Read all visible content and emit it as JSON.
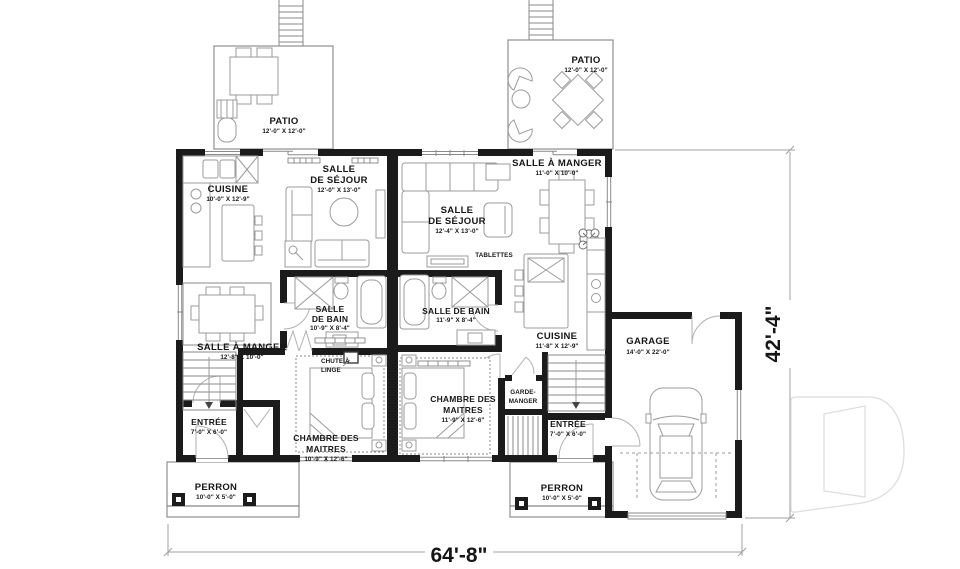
{
  "rooms": {
    "patio_left": {
      "name": "PATIO",
      "dims": "12'-0\" X 12'-0\""
    },
    "patio_right": {
      "name": "PATIO",
      "dims": "12'-0\" X 12'-0\""
    },
    "cuisine_left": {
      "name": "CUISINE",
      "dims": "10'-0\" X 12'-9\""
    },
    "sejour_left": {
      "name_line1": "SALLE",
      "name_line2": "DE SÉJOUR",
      "dims": "12'-0\" X 13'-0\""
    },
    "manger_right": {
      "name": "SALLE À MANGER",
      "dims": "11'-0\" X 10'-0\""
    },
    "sejour_right": {
      "name_line1": "SALLE",
      "name_line2": "DE SÉJOUR",
      "dims": "12'-4\" X 13'-0\""
    },
    "manger_left": {
      "name": "SALLE À MANGER",
      "dims": "12'-8\" X 10'-0\""
    },
    "bain_left": {
      "name_line1": "SALLE",
      "name_line2": "DE BAIN",
      "dims": "10'-9\" X 8'-4\""
    },
    "bain_right": {
      "name": "SALLE DE BAIN",
      "dims": "11'-9\" X 8'-4\""
    },
    "cuisine_right": {
      "name": "CUISINE",
      "dims": "11'-8\" X 12'-9\""
    },
    "garage": {
      "name": "GARAGE",
      "dims": "14'-0\" X 22'-0\""
    },
    "chambre_left": {
      "name_line1": "CHAMBRE DES",
      "name_line2": "MAITRES",
      "dims": "10'-9\" X 12'-6\""
    },
    "chambre_right": {
      "name_line1": "CHAMBRE DES",
      "name_line2": "MAITRES",
      "dims": "11'-9\" X 12'-6\""
    },
    "entree_left": {
      "name": "ENTRÉE",
      "dims": "7'-0\" X 6'-0\""
    },
    "entree_right": {
      "name": "ENTRÉE",
      "dims": "7'-0\" X 6'-0\""
    },
    "perron_left": {
      "name": "PERRON",
      "dims": "10'-0\" X 5'-0\""
    },
    "perron_right": {
      "name": "PERRON",
      "dims": "10'-0\" X 5'-0\""
    }
  },
  "annotations": {
    "tablettes": "TABLETTES",
    "chute_line1": "CHUTE À",
    "chute_line2": "LINGE",
    "garde_manger_line1": "GARDE-",
    "garde_manger_line2": "MANGER"
  },
  "dimensions": {
    "overall_width": "64'-8\"",
    "overall_height": "42'-4\""
  },
  "watermark": {
    "letter": "D"
  },
  "colors": {
    "wall": "#1b1b1b",
    "furniture_line": "#9b9b9b",
    "text": "#161616",
    "watermark_line": "#dedede"
  }
}
